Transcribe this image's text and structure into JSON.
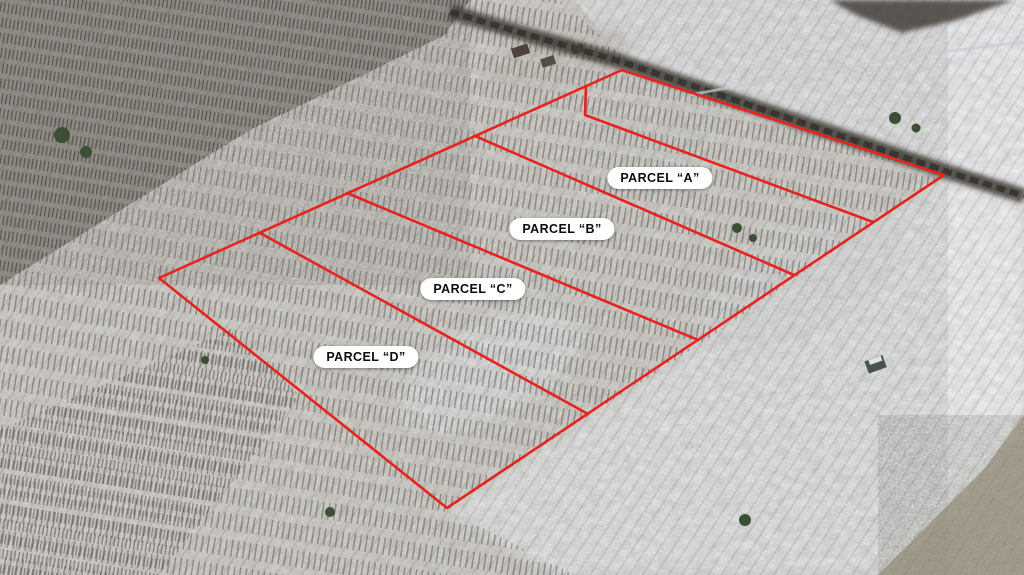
{
  "scene": {
    "type": "aerial-photo-parcel-overlay",
    "season": "winter-snow",
    "boundary_color": "#e8231e",
    "label_bg": "#ffffff",
    "label_text_color": "#0d0d0d"
  },
  "parcels": [
    {
      "id": "A",
      "label": "PARCEL “A”",
      "x": 660,
      "y": 178
    },
    {
      "id": "B",
      "label": "PARCEL “B”",
      "x": 562,
      "y": 229
    },
    {
      "id": "C",
      "label": "PARCEL “C”",
      "x": 473,
      "y": 289
    },
    {
      "id": "D",
      "label": "PARCEL “D”",
      "x": 366,
      "y": 357
    }
  ],
  "boundaries": {
    "outer": [
      [
        159,
        278
      ],
      [
        622,
        70
      ],
      [
        944,
        175
      ],
      [
        447,
        508
      ]
    ],
    "dividers": [
      {
        "name": "parcel-a-north-line",
        "points": [
          [
            586,
            86
          ],
          [
            585,
            115
          ],
          [
            873,
            222
          ]
        ]
      },
      {
        "name": "parcel-a-b-line",
        "points": [
          [
            475,
            136
          ],
          [
            794,
            275
          ]
        ]
      },
      {
        "name": "parcel-b-c-line",
        "points": [
          [
            347,
            193
          ],
          [
            698,
            340
          ]
        ]
      },
      {
        "name": "parcel-c-d-line",
        "points": [
          [
            260,
            233
          ],
          [
            588,
            414
          ]
        ]
      }
    ]
  }
}
